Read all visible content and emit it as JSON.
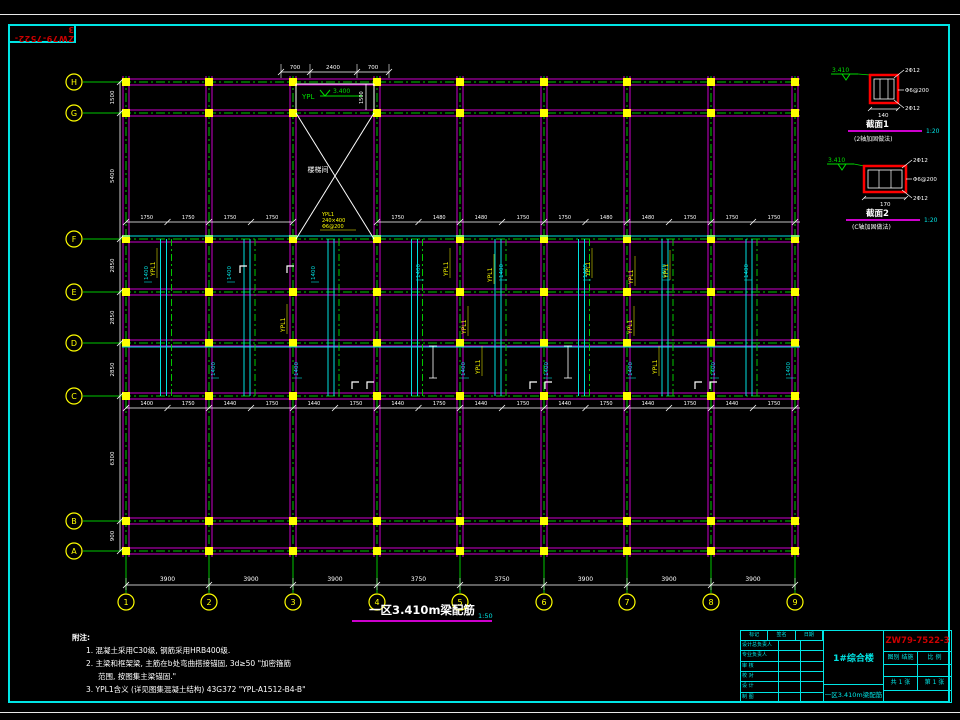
{
  "sheet": {
    "stamp": "ZW79-7522-3",
    "colors": {
      "beam": "#cc00cc",
      "centerline": "#00c800",
      "axis": "#ffff00",
      "dim": "#ffffff",
      "aux": "#00e0e0",
      "accent": "#ff0000",
      "frame": "#00e5e5"
    }
  },
  "plan": {
    "title": "一区3.410m梁配筋",
    "scale": "1:50",
    "cols": [
      {
        "label": "1",
        "x": 126
      },
      {
        "label": "2",
        "x": 209
      },
      {
        "label": "3",
        "x": 293
      },
      {
        "label": "4",
        "x": 377
      },
      {
        "label": "5",
        "x": 460
      },
      {
        "label": "6",
        "x": 544
      },
      {
        "label": "7",
        "x": 627
      },
      {
        "label": "8",
        "x": 711
      },
      {
        "label": "9",
        "x": 795
      }
    ],
    "rows": [
      {
        "label": "H",
        "y": 82
      },
      {
        "label": "G",
        "y": 113
      },
      {
        "label": "F",
        "y": 239
      },
      {
        "label": "E",
        "y": 292
      },
      {
        "label": "D",
        "y": 343
      },
      {
        "label": "C",
        "y": 396
      },
      {
        "label": "B",
        "y": 521
      },
      {
        "label": "A",
        "y": 551
      }
    ],
    "bottom_dims": [
      "3900",
      "3900",
      "3900",
      "3750",
      "3750",
      "3900",
      "3900",
      "3900"
    ],
    "left_dims": [
      "1500",
      "5400",
      "2850",
      "2850",
      "2850",
      "6300",
      "900"
    ],
    "top_dims": [
      "700",
      "2400",
      "700"
    ],
    "upper_dims": [
      [
        "1750",
        "1750"
      ],
      [
        "1750",
        "1750"
      ],
      [],
      [
        "1750",
        "1480"
      ],
      [
        "1480",
        "1750"
      ],
      [
        "1750",
        "1480"
      ],
      [
        "1480",
        "1750"
      ],
      [
        "1750",
        "1750"
      ]
    ],
    "lower_dims": [
      [
        "1400",
        "1750"
      ],
      [
        "1440",
        "1750"
      ],
      [
        "1440",
        "1750"
      ],
      [
        "1440",
        "1750"
      ],
      [
        "1440",
        "1750"
      ],
      [
        "1440",
        "1750"
      ],
      [
        "1440",
        "1750"
      ],
      [
        "1440",
        "1750"
      ]
    ],
    "stair_label": "楼梯间",
    "level_label": {
      "name": "YPL",
      "value": "3.400"
    },
    "stair_vdim": "1500",
    "cyan_dim_text": "1400",
    "cyan_dim_positions": [
      {
        "x": 148,
        "y": 268
      },
      {
        "x": 231,
        "y": 268
      },
      {
        "x": 315,
        "y": 268
      },
      {
        "x": 420,
        "y": 266
      },
      {
        "x": 503,
        "y": 266
      },
      {
        "x": 587,
        "y": 266
      },
      {
        "x": 666,
        "y": 266
      },
      {
        "x": 748,
        "y": 266
      },
      {
        "x": 215,
        "y": 364
      },
      {
        "x": 298,
        "y": 364
      },
      {
        "x": 465,
        "y": 364
      },
      {
        "x": 548,
        "y": 364
      },
      {
        "x": 632,
        "y": 364
      },
      {
        "x": 715,
        "y": 364
      },
      {
        "x": 790,
        "y": 364
      }
    ],
    "beam_label_text": "YPL1",
    "beam_label_positions": [
      {
        "x": 155,
        "y": 262
      },
      {
        "x": 285,
        "y": 318
      },
      {
        "x": 448,
        "y": 262
      },
      {
        "x": 492,
        "y": 268
      },
      {
        "x": 590,
        "y": 262
      },
      {
        "x": 633,
        "y": 270
      },
      {
        "x": 668,
        "y": 264
      },
      {
        "x": 466,
        "y": 320
      },
      {
        "x": 632,
        "y": 320
      },
      {
        "x": 480,
        "y": 360
      },
      {
        "x": 657,
        "y": 360
      }
    ],
    "stair_beam_label": [
      "YPL1",
      "240×400",
      "Φ6@200"
    ],
    "bracket_positions": [
      {
        "x": 240,
        "y": 266
      },
      {
        "x": 287,
        "y": 266
      },
      {
        "x": 352,
        "y": 382
      },
      {
        "x": 367,
        "y": 382
      },
      {
        "x": 530,
        "y": 382
      },
      {
        "x": 545,
        "y": 382
      },
      {
        "x": 695,
        "y": 382
      },
      {
        "x": 710,
        "y": 382
      }
    ]
  },
  "details": [
    {
      "title": "截面1",
      "scale": "1:20",
      "sub": "(2轴加固做法)",
      "level": "3.410",
      "top_rebar": "2Φ12",
      "stirrup": "Φ6@200",
      "bottom_rebar": "2Φ12",
      "width_dim": "140"
    },
    {
      "title": "截面2",
      "scale": "1:20",
      "sub": "(C轴加固做法)",
      "level": "3.410",
      "top_rebar": "2Φ12",
      "stirrup": "Φ6@200",
      "bottom_rebar": "2Φ12",
      "width_dim": "170"
    }
  ],
  "notes": {
    "heading": "附注:",
    "l1": "1. 混凝土采用C30级, 钢筋采用HRB400级.",
    "l2": "2. 主梁和框架梁, 主筋在b处弯曲搭接锚固, 3d≥50 \"加密箍筋",
    "l3": "范围, 按图集主梁锚固.\"",
    "l4": "3. YPL1含义 (详见图集混凝土结构) 43G372 \"YPL-A1512-B4-B\""
  },
  "titleblock": {
    "project": "1#综合楼",
    "drawing_no": "ZW79-7522-3",
    "drawing_title": "一区3.410m梁配筋",
    "header": [
      "标记",
      "签名",
      "日期"
    ],
    "left_rows": [
      "设计总负责人",
      "专业负责人",
      "审 核",
      "校 对",
      "设 计",
      "制 图"
    ],
    "type_cells": [
      "图别 结施",
      "比 例"
    ],
    "sheet_cells": [
      "共 1 张",
      "第 1 张"
    ]
  }
}
